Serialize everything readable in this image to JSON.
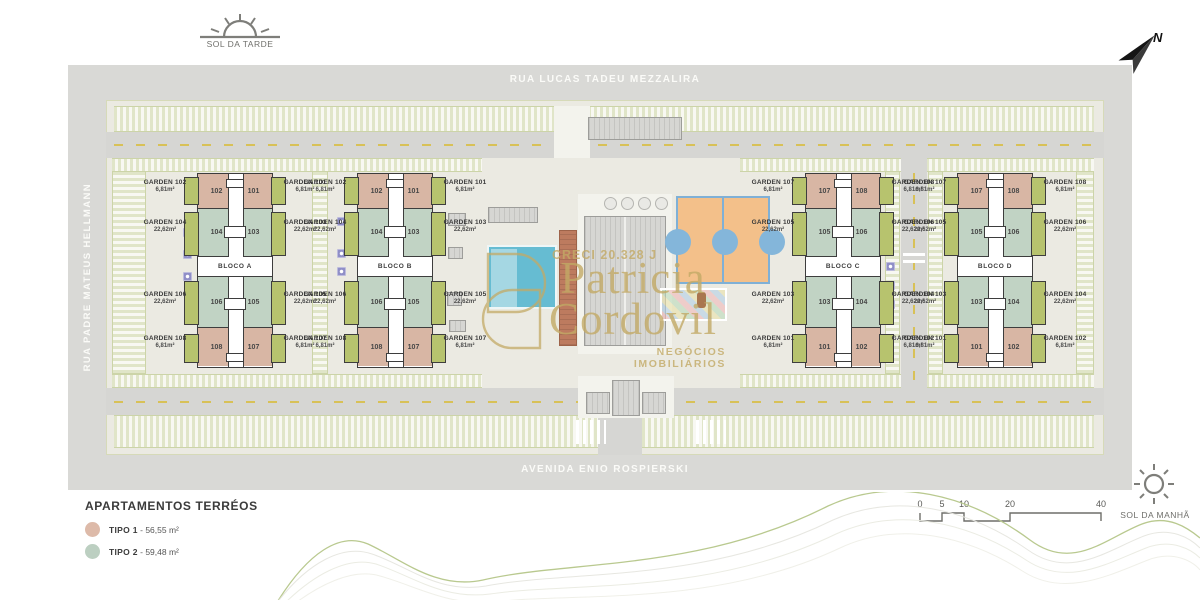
{
  "compass": {
    "sol_da_tarde": "SOL DA TARDE",
    "sol_da_manha": "SOL DA MANHÃ",
    "north_label": "N"
  },
  "streets": {
    "top": "RUA LUCAS TADEU MEZZALIRA",
    "left": "RUA PADRE MATEUS HELLMANN",
    "bottom": "AVENIDA ENIO ROSPIERSKI"
  },
  "watermark": {
    "creci": "CRECI 20.328 J",
    "name_line1": "Patricia",
    "name_line2": "Cordovil",
    "tagline": "NEGÓCIOS IMOBILIÁRIOS"
  },
  "legend": {
    "title": "APARTAMENTOS TERRÉOS",
    "items": [
      {
        "label": "TIPO 1",
        "separator": "-",
        "area": "56,55 m²",
        "color": "#ddbaa9"
      },
      {
        "label": "TIPO 2",
        "separator": "-",
        "area": "59,48 m²",
        "color": "#bccfc1"
      }
    ]
  },
  "scale_bar": {
    "ticks": [
      "0",
      "5",
      "10",
      "20",
      "40"
    ]
  },
  "colors": {
    "tipo1_unit": "#d8b6a4",
    "tipo2_unit": "#c1d3c4",
    "garden_strip": "#b7c36e",
    "road": "#d9d9d6",
    "site": "#ebeae2",
    "watermark_gold": "#c3aa66"
  },
  "blocks": [
    {
      "name": "BLOCO A",
      "units": [
        [
          "102",
          "101"
        ],
        [
          "104",
          "103"
        ],
        [
          "106",
          "105"
        ],
        [
          "108",
          "107"
        ]
      ],
      "left_labels": [
        {
          "name": "GARDEN 102",
          "area": "6,81m²"
        },
        {
          "name": "GARDEN 104",
          "area": "22,62m²"
        },
        {
          "name": "GARDEN 106",
          "area": "22,62m²"
        },
        {
          "name": "GARDEN 108",
          "area": "6,81m²"
        }
      ],
      "right_labels": [
        {
          "name": "GARDEN 101",
          "area": "6,81m²"
        },
        {
          "name": "GARDEN 103",
          "area": "22,62m²"
        },
        {
          "name": "GARDEN 105",
          "area": "22,62m²"
        },
        {
          "name": "GARDEN 107",
          "area": "6,81m²"
        }
      ]
    },
    {
      "name": "BLOCO B",
      "units": [
        [
          "102",
          "101"
        ],
        [
          "104",
          "103"
        ],
        [
          "106",
          "105"
        ],
        [
          "108",
          "107"
        ]
      ],
      "left_labels": [
        {
          "name": "GARDEN 102",
          "area": "6,81m²"
        },
        {
          "name": "GARDEN 104",
          "area": "22,62m²"
        },
        {
          "name": "GARDEN 106",
          "area": "22,62m²"
        },
        {
          "name": "GARDEN 108",
          "area": "6,81m²"
        }
      ],
      "right_labels": [
        {
          "name": "GARDEN 101",
          "area": "6,81m²"
        },
        {
          "name": "GARDEN 103",
          "area": "22,62m²"
        },
        {
          "name": "GARDEN 105",
          "area": "22,62m²"
        },
        {
          "name": "GARDEN 107",
          "area": "6,81m²"
        }
      ]
    },
    {
      "name": "BLOCO C",
      "units": [
        [
          "107",
          "108"
        ],
        [
          "105",
          "106"
        ],
        [
          "103",
          "104"
        ],
        [
          "101",
          "102"
        ]
      ],
      "left_labels": [
        {
          "name": "GARDEN 107",
          "area": "6,81m²"
        },
        {
          "name": "GARDEN 105",
          "area": "22,62m²"
        },
        {
          "name": "GARDEN 103",
          "area": "22,62m²"
        },
        {
          "name": "GARDEN 101",
          "area": "6,81m²"
        }
      ],
      "right_labels": [
        {
          "name": "GARDEN 108",
          "area": "6,81m²"
        },
        {
          "name": "GARDEN 106",
          "area": "22,62m²"
        },
        {
          "name": "GARDEN 104",
          "area": "22,62m²"
        },
        {
          "name": "GARDEN 102",
          "area": "6,81m²"
        }
      ]
    },
    {
      "name": "BLOCO D",
      "units": [
        [
          "107",
          "108"
        ],
        [
          "105",
          "106"
        ],
        [
          "103",
          "104"
        ],
        [
          "101",
          "102"
        ]
      ],
      "left_labels": [
        {
          "name": "GARDEN 107",
          "area": "6,81m²"
        },
        {
          "name": "GARDEN 105",
          "area": "22,62m²"
        },
        {
          "name": "GARDEN 103",
          "area": "22,62m²"
        },
        {
          "name": "GARDEN 101",
          "area": "6,81m²"
        }
      ],
      "right_labels": [
        {
          "name": "GARDEN 108",
          "area": "6,81m²"
        },
        {
          "name": "GARDEN 106",
          "area": "22,62m²"
        },
        {
          "name": "GARDEN 104",
          "area": "22,62m²"
        },
        {
          "name": "GARDEN 102",
          "area": "6,81m²"
        }
      ]
    }
  ]
}
